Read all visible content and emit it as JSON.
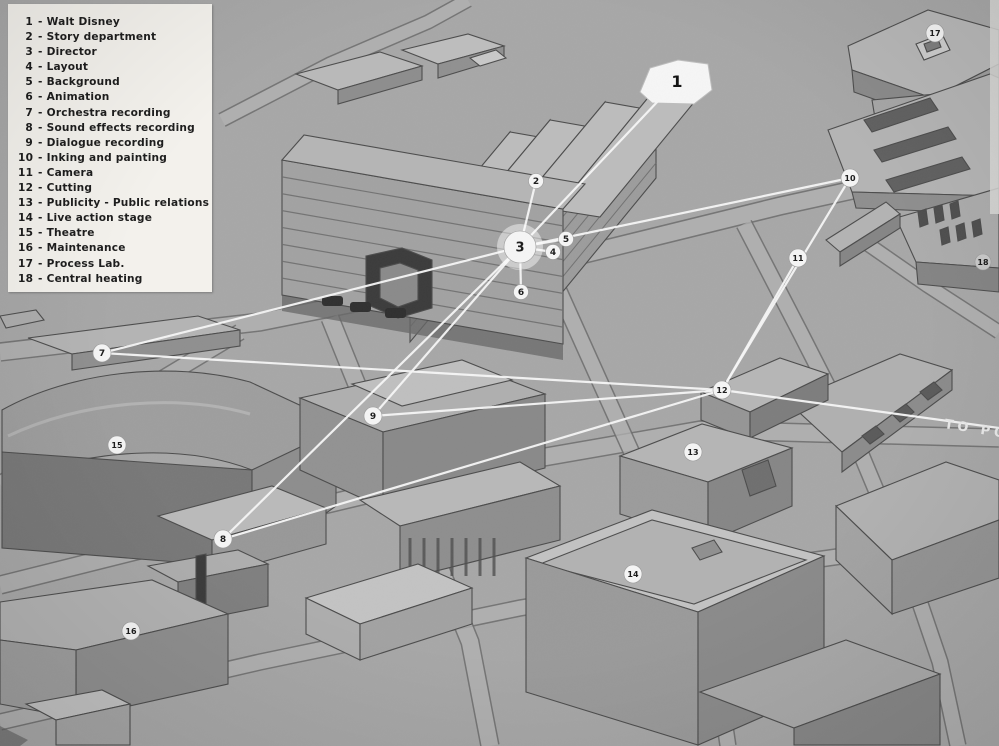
{
  "title": "Studio plant layout diagram with numbered departments",
  "colors": {
    "ground": "#a7a7a7",
    "flow_line": "#f7f7f7",
    "legend_bg": "#f3f1ec",
    "ink": "#1e1e1e",
    "road_label_color": "#e9e9e9"
  },
  "legend": {
    "items": [
      {
        "num": "1",
        "label": "Walt Disney"
      },
      {
        "num": "2",
        "label": "Story department"
      },
      {
        "num": "3",
        "label": "Director"
      },
      {
        "num": "4",
        "label": "Layout"
      },
      {
        "num": "5",
        "label": "Background"
      },
      {
        "num": "6",
        "label": "Animation"
      },
      {
        "num": "7",
        "label": "Orchestra recording"
      },
      {
        "num": "8",
        "label": "Sound effects recording"
      },
      {
        "num": "9",
        "label": "Dialogue recording"
      },
      {
        "num": "10",
        "label": "Inking and painting"
      },
      {
        "num": "11",
        "label": "Camera"
      },
      {
        "num": "12",
        "label": "Cutting"
      },
      {
        "num": "13",
        "label": "Publicity - Public relations"
      },
      {
        "num": "14",
        "label": "Live action stage"
      },
      {
        "num": "15",
        "label": "Theatre"
      },
      {
        "num": "16",
        "label": "Maintenance"
      },
      {
        "num": "17",
        "label": "Process Lab."
      },
      {
        "num": "18",
        "label": "Central heating"
      }
    ]
  },
  "road_label": {
    "text": "TO PO",
    "x": 944,
    "y": 428,
    "angle": 9
  },
  "markers": [
    {
      "id": "1",
      "x": 677,
      "y": 81,
      "r": 0,
      "style": "blob"
    },
    {
      "id": "2",
      "x": 536,
      "y": 181,
      "r": 7.5
    },
    {
      "id": "3",
      "x": 520,
      "y": 247,
      "r": 16,
      "style": "hub"
    },
    {
      "id": "4",
      "x": 553,
      "y": 252,
      "r": 7.5
    },
    {
      "id": "5",
      "x": 566,
      "y": 239,
      "r": 7.5
    },
    {
      "id": "6",
      "x": 521,
      "y": 292,
      "r": 7.5
    },
    {
      "id": "7",
      "x": 102,
      "y": 353,
      "r": 9
    },
    {
      "id": "8",
      "x": 223,
      "y": 539,
      "r": 9
    },
    {
      "id": "9",
      "x": 373,
      "y": 416,
      "r": 9
    },
    {
      "id": "10",
      "x": 850,
      "y": 178,
      "r": 9
    },
    {
      "id": "11",
      "x": 798,
      "y": 258,
      "r": 9
    },
    {
      "id": "12",
      "x": 722,
      "y": 390,
      "r": 9
    },
    {
      "id": "13",
      "x": 693,
      "y": 452,
      "r": 9
    },
    {
      "id": "14",
      "x": 633,
      "y": 574,
      "r": 9
    },
    {
      "id": "15",
      "x": 117,
      "y": 445,
      "r": 9
    },
    {
      "id": "16",
      "x": 131,
      "y": 631,
      "r": 9
    },
    {
      "id": "17",
      "x": 935,
      "y": 33,
      "r": 9
    },
    {
      "id": "18",
      "x": 983,
      "y": 262,
      "r": 8,
      "style": "dim"
    }
  ],
  "connections": [
    [
      "1",
      "3"
    ],
    [
      "2",
      "3"
    ],
    [
      "3",
      "4"
    ],
    [
      "3",
      "5"
    ],
    [
      "3",
      "6"
    ],
    [
      "3",
      "7"
    ],
    [
      "3",
      "8"
    ],
    [
      "3",
      "9"
    ],
    [
      "3",
      "10"
    ],
    [
      "7",
      "12"
    ],
    [
      "8",
      "12"
    ],
    [
      "9",
      "12"
    ],
    [
      "10",
      "12"
    ],
    [
      "11",
      "12"
    ]
  ],
  "extra_lines": [
    [
      722,
      390,
      999,
      428
    ]
  ]
}
